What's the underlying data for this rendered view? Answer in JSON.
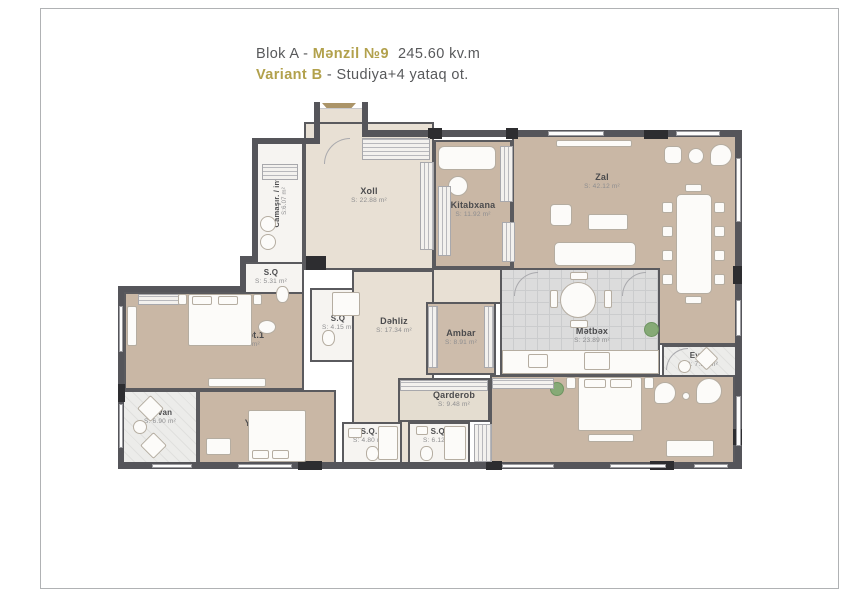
{
  "title": {
    "line1_prefix": "Blok A - ",
    "line1_unit": "Mənzil №9",
    "line1_area": "245.60 kv.m",
    "line2_variant": "Variant B",
    "line2_desc": " - Studiya+4 yataq ot."
  },
  "colors": {
    "accent_gold": "#b2a14c",
    "text_gray": "#58595b",
    "wall": "#55555a",
    "floor_tan": "#c9b7a5",
    "floor_beige": "#e8e0d4",
    "floor_tile": "#dcdcdc",
    "plant_green": "#86aa76"
  },
  "icons": {
    "entrance_arrow": "entrance-arrow"
  },
  "rooms": [
    {
      "name": "Camaşır. / inv.",
      "area": "S:6.07 m²"
    },
    {
      "name": "Xoll",
      "area": "S: 22.88 m²"
    },
    {
      "name": "Kitabxana",
      "area": "S: 11.92 m²"
    },
    {
      "name": "Zal",
      "area": "S: 42.12 m²"
    },
    {
      "name": "S.Q",
      "area": "S: 5.31 m²"
    },
    {
      "name": "S.Q",
      "area": "S: 4.15 m²"
    },
    {
      "name": "Dəhliz",
      "area": "S: 17.34 m²"
    },
    {
      "name": "Ambar",
      "area": "S: 8.91 m²"
    },
    {
      "name": "Mətbəx",
      "area": "S: 23.89 m²"
    },
    {
      "name": "Eyvan",
      "area": "S: 7.14 m²"
    },
    {
      "name": "Yataq ot.1",
      "area": "S: 25.14 m²"
    },
    {
      "name": "Eyvan",
      "area": "S: 6.90 m²"
    },
    {
      "name": "Yataq ot.2",
      "area": "S: 17.49 m²"
    },
    {
      "name": "Qarderob",
      "area": "S: 9.48 m²"
    },
    {
      "name": "S.Q.",
      "area": "S: 4.80 m²"
    },
    {
      "name": "S.Q.",
      "area": "S: 6.12 m²"
    },
    {
      "name": "Yataq ot.",
      "area": "S: 29.16 m²"
    }
  ]
}
